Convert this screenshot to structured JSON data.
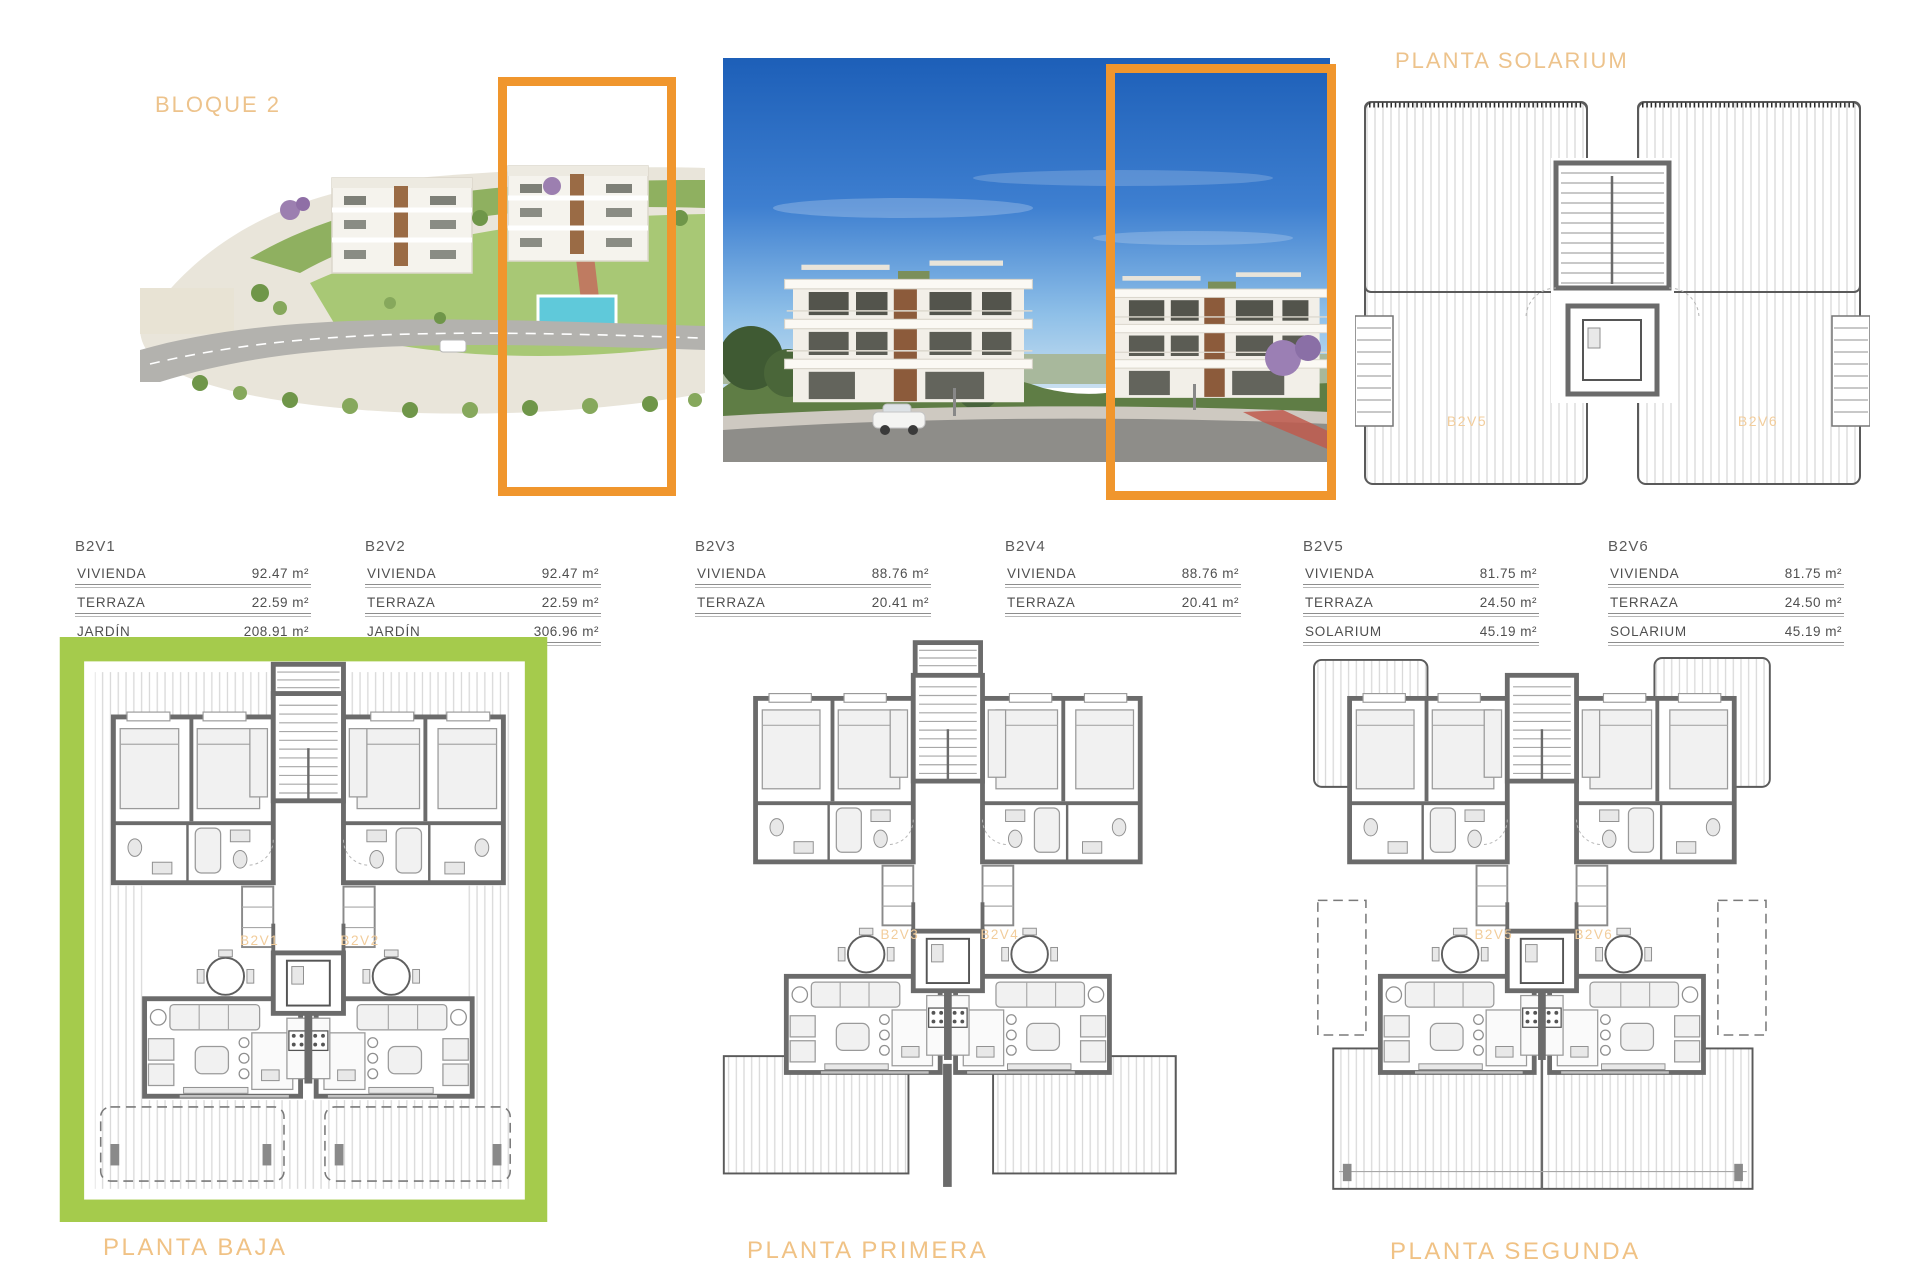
{
  "headings": {
    "bloque": "BLOQUE 2",
    "solarium": "PLANTA SOLARIUM"
  },
  "captions": {
    "baja": "PLANTA BAJA",
    "primera": "PLANTA PRIMERA",
    "segunda": "PLANTA SEGUNDA"
  },
  "unit_tables": [
    {
      "name": "B2V1",
      "rows": [
        {
          "label": "VIVIENDA",
          "value": "92.47 m²"
        },
        {
          "label": "TERRAZA",
          "value": "22.59 m²"
        },
        {
          "label": "JARDÍN",
          "value": "208.91 m²"
        }
      ]
    },
    {
      "name": "B2V2",
      "rows": [
        {
          "label": "VIVIENDA",
          "value": "92.47 m²"
        },
        {
          "label": "TERRAZA",
          "value": "22.59 m²"
        },
        {
          "label": "JARDÍN",
          "value": "306.96 m²"
        }
      ]
    },
    {
      "name": "B2V3",
      "rows": [
        {
          "label": "VIVIENDA",
          "value": "88.76 m²"
        },
        {
          "label": "TERRAZA",
          "value": "20.41 m²"
        }
      ]
    },
    {
      "name": "B2V4",
      "rows": [
        {
          "label": "VIVIENDA",
          "value": "88.76 m²"
        },
        {
          "label": "TERRAZA",
          "value": "20.41 m²"
        }
      ]
    },
    {
      "name": "B2V5",
      "rows": [
        {
          "label": "VIVIENDA",
          "value": "81.75 m²"
        },
        {
          "label": "TERRAZA",
          "value": "24.50 m²"
        },
        {
          "label": "SOLARIUM",
          "value": "45.19 m²"
        }
      ]
    },
    {
      "name": "B2V6",
      "rows": [
        {
          "label": "VIVIENDA",
          "value": "81.75 m²"
        },
        {
          "label": "TERRAZA",
          "value": "24.50 m²"
        },
        {
          "label": "SOLARIUM",
          "value": "45.19 m²"
        }
      ]
    }
  ],
  "plans": {
    "solarium": {
      "units": [
        "B2V5",
        "B2V6"
      ]
    },
    "baja": {
      "units": [
        "B2V1",
        "B2V2"
      ]
    },
    "primera": {
      "units": [
        "B2V3",
        "B2V4"
      ]
    },
    "segunda": {
      "units": [
        "B2V5",
        "B2V6"
      ]
    }
  },
  "colors": {
    "accent_orange": "#F0962D",
    "heading_tan": "#EDC38C",
    "garden_green": "#A5CB4C",
    "wall_gray": "#6B6B6B"
  }
}
